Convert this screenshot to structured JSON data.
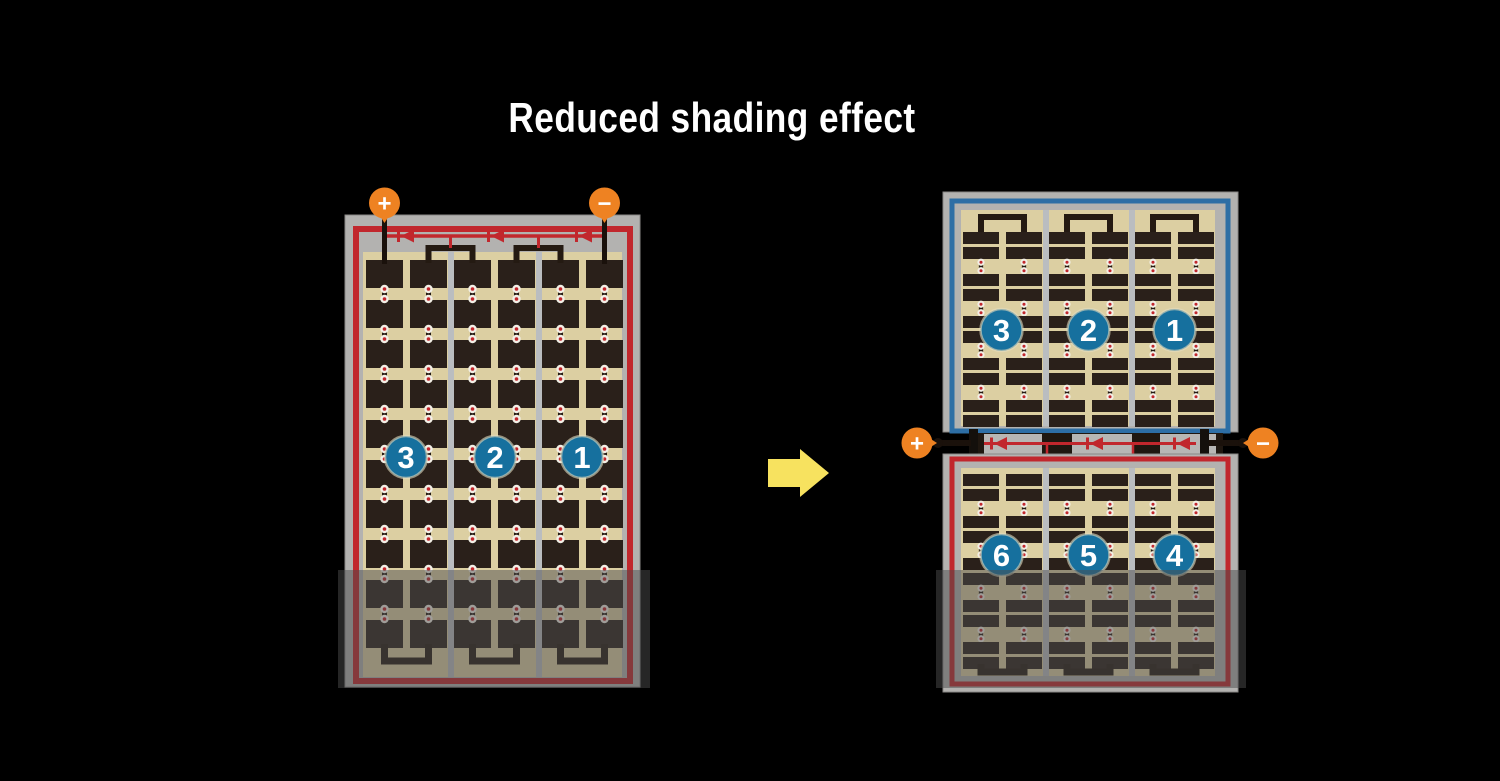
{
  "title": "Reduced shading effect",
  "colors": {
    "background": "#000000",
    "title_text": "#ffffff",
    "frame_gray": "#b3b2b0",
    "divider_gray": "#babdc0",
    "border_red": "#c1272d",
    "border_blue": "#2d6ea5",
    "backsheet_cream": "#dccfa2",
    "cell_dark": "#2a201a",
    "wire_black": "#1a110b",
    "badge_blue": "#16709e",
    "badge_text": "#ffffff",
    "terminal_orange": "#ee8222",
    "terminal_text": "#ffffff",
    "arrow_yellow": "#f7e25f",
    "rivet_white": "#f2efe6",
    "rivet_red": "#c1272d",
    "shade_overlay": "rgba(75,75,75,0.5)"
  },
  "left_module": {
    "string_badges": [
      "3",
      "2",
      "1"
    ],
    "positive_terminal": "+",
    "negative_terminal": "−",
    "diode_count": 3
  },
  "right_module": {
    "top_string_badges": [
      "3",
      "2",
      "1"
    ],
    "bottom_string_badges": [
      "6",
      "5",
      "4"
    ],
    "positive_terminal": "+",
    "negative_terminal": "−",
    "diode_count": 3
  }
}
